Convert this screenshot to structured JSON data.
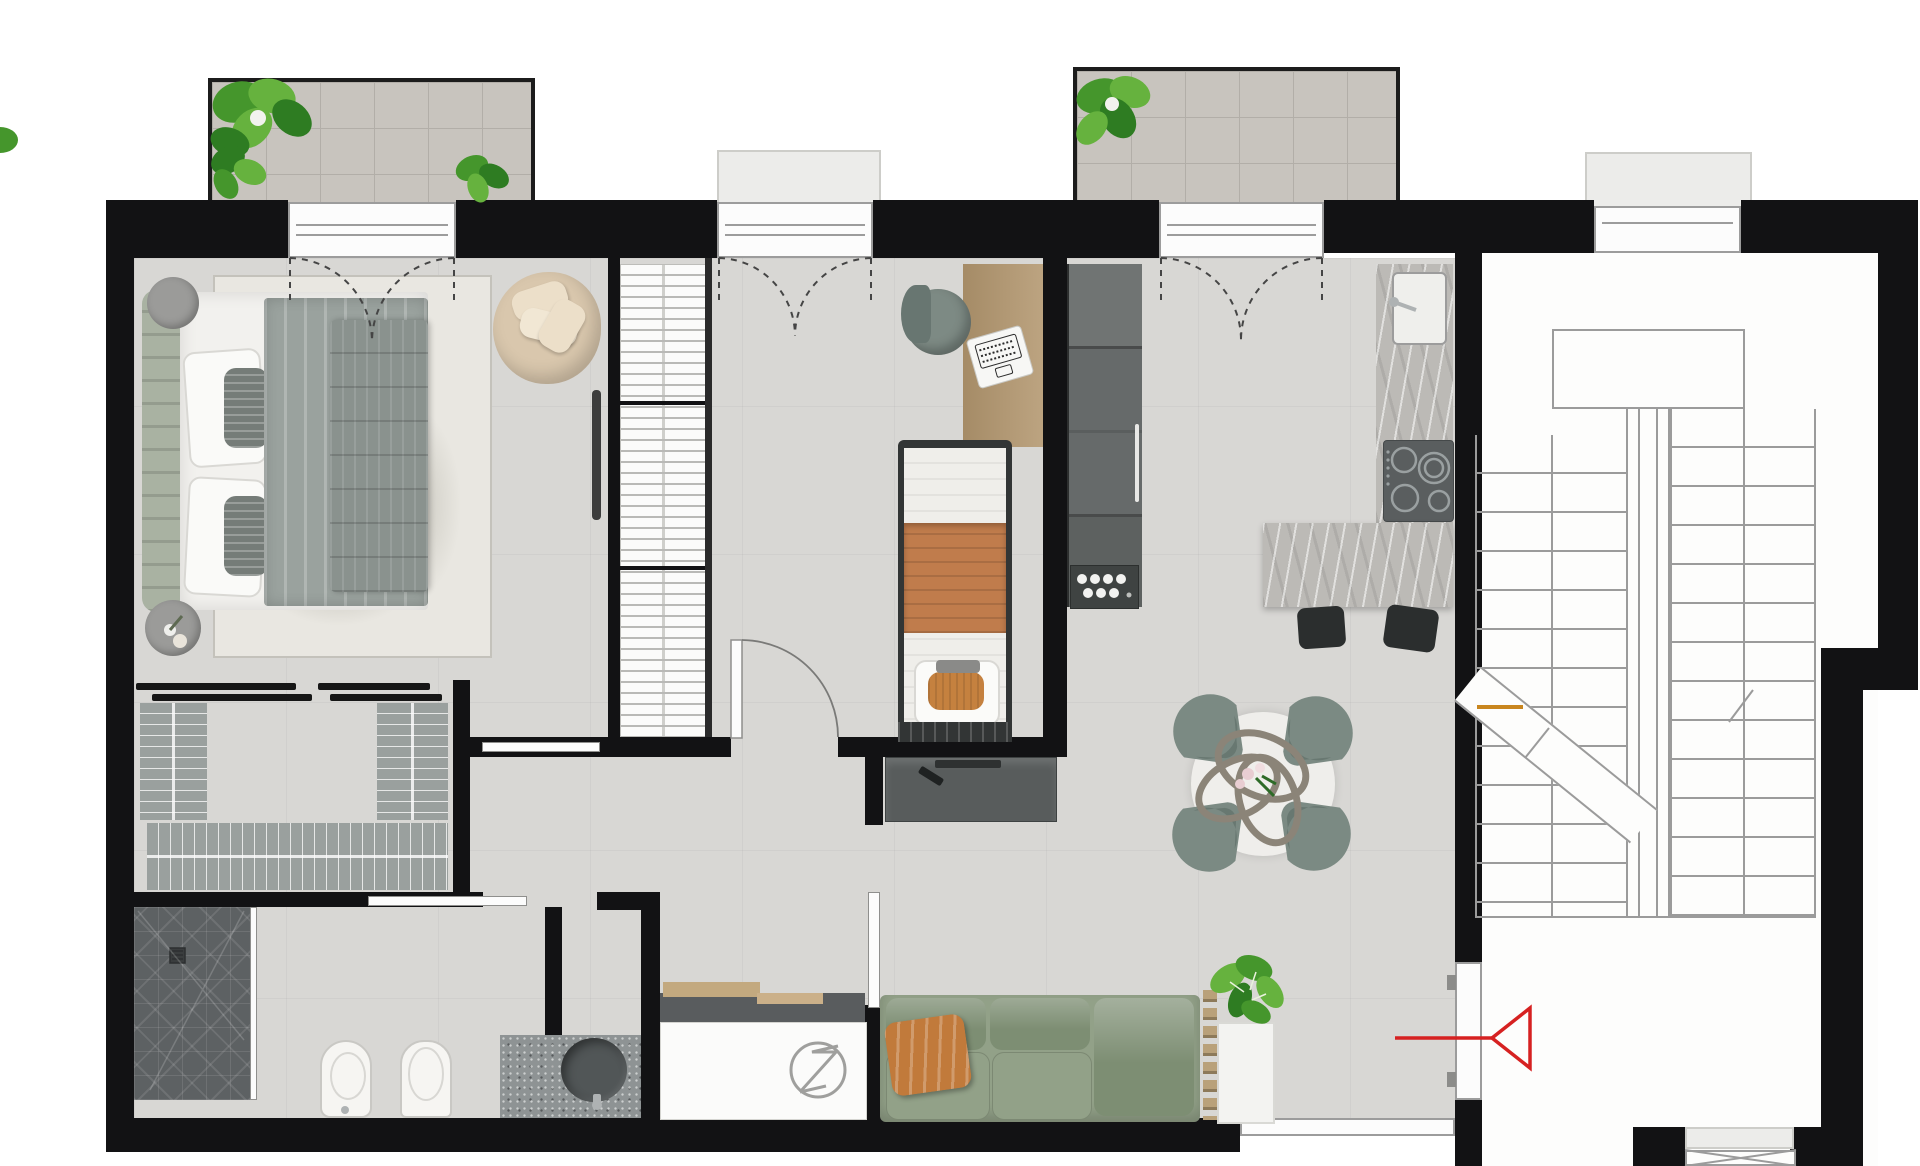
{
  "meta": {
    "title": "apartment-floor-plan-render",
    "canvas_width": 1920,
    "canvas_height": 1166,
    "style": "top-down 3D architectural render, no text labels"
  },
  "colors": {
    "outside": "#ffffff",
    "wall": "#121214",
    "floor": "#d8d7d4",
    "floorLine": "rgba(0,0,0,0.035)",
    "stairFloor": "#fdfdfc",
    "stairLine": "#9b9b9b",
    "stairOrange": "#c9861f",
    "balconyTile": "#c8c4be",
    "balconyGrout": "#b2aea8",
    "platform": "#ececea",
    "platformEdge": "#cdcdc9",
    "doorWhite": "#fcfcfc",
    "frameGrey": "#9c9c9c",
    "dash": "#454545",
    "marble": "#bcbab6",
    "marbleVein": "rgba(255,255,255,0.55)",
    "marbleShade": "rgba(110,110,108,0.18)",
    "cabinet": "#707473",
    "cabinetMid": "#636766",
    "cabinetDark": "#565a59",
    "cabinetCube": "#3f4342",
    "dotWhite": "#f2f2f0",
    "handle": "#e8e8e6",
    "hangerBg": "#fbfbfa",
    "hangerLine": "#b9b9b6",
    "closetMat": "#9aa09e",
    "matLine": "rgba(255,255,255,0.75)",
    "railBlack": "#161616",
    "rug": "#e9e7e1",
    "rugSwirl": "#c9c6bd",
    "headboard": "#a9b2a2",
    "sheet": "#f2f1ee",
    "pillowTrim": "#d9d8d4",
    "pillowGrey": "#757c78",
    "blanket": "#9aa29e",
    "quilt": "#8a928e",
    "armchair": "#d9c7ad",
    "armchairPillow": "#ecdfc9",
    "sideTable": "#9b9b99",
    "radiator": "#3c3c3c",
    "deskWood": "#b3976f",
    "chairGrey": "#7d8a84",
    "chairGreyDark": "#687671",
    "laptop": "#f7f7f5",
    "laptopKeys": "#2b2b2b",
    "bedFrame": "#323535",
    "terracotta": "#c07c4c",
    "quiltWhite": "#efeeea",
    "cushionOrange": "#c5813f",
    "consoleGrey": "#585c5c",
    "consoleDark": "#2e3131",
    "shower": "#5d6163",
    "showerLine": "rgba(255,255,255,0.10)",
    "drain": "#3a3d3e",
    "porcelain": "#f6f5f2",
    "porcelainEdge": "#c9c8c4",
    "counterSpeckle": "#8e9394",
    "basin": "#515657",
    "chrome": "#aeb2b3",
    "techCounter": "#595c5e",
    "techWood": "#c3a97f",
    "boiler": "#fbfbfa",
    "logoGrey": "#9f9f9d",
    "sofa": "#92a188",
    "sofaDark": "#7d8e73",
    "throw": "#c17a3b",
    "plantDark": "#2e7c22",
    "plantMid": "#45962c",
    "plantLight": "#66b23e",
    "planter": "#f3f3f1",
    "ladder": "#b9a17a",
    "diningChair": "#7b8a83",
    "diningChairDark": "#64736d",
    "ringsCol": "#8b8478",
    "tableWhite": "#efeeeb",
    "stool": "#2b2e2e",
    "windowStrip": "#f4f4f2",
    "red": "#d62121"
  },
  "inventory": [
    "balcony-with-plants-left",
    "balcony-with-plants-right",
    "double-bed",
    "nightstand",
    "nightstand",
    "round-armchair",
    "area-rug",
    "walk-in-closet-hanger-racks",
    "wardrobe-hanger-column",
    "desk-with-laptop",
    "desk-chair",
    "single-bed",
    "tv-console",
    "kitchen-tall-cabinets",
    "kitchen-counter-with-sink",
    "induction-cooktop",
    "kitchen-island",
    "bar-stools",
    "dining-table-4-chairs",
    "ring-centerpiece",
    "sofa-3-seat",
    "potted-plant",
    "planter-box",
    "shower",
    "bidet",
    "toilet",
    "vanity-basin",
    "boiler-unit",
    "staircase",
    "entrance-door",
    "entrance-arrow"
  ],
  "entrance": {
    "arrow_direction": "left",
    "arrow_color": "#d62121"
  },
  "dining": {
    "chair_count": 4
  },
  "sofa": {
    "cushion_count": 3
  }
}
